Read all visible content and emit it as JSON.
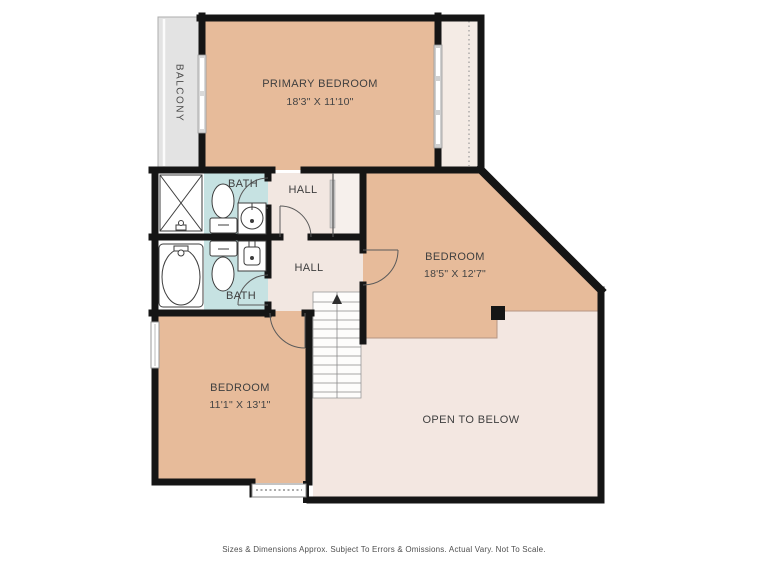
{
  "plan": {
    "rooms": {
      "primary_bedroom": {
        "label": "PRIMARY BEDROOM",
        "dims": "18'3\" X 11'10\""
      },
      "balcony": {
        "label": "BALCONY"
      },
      "bath_top": {
        "label": "BATH"
      },
      "hall_top": {
        "label": "HALL"
      },
      "bath_bottom": {
        "label": "BATH"
      },
      "hall_bottom": {
        "label": "HALL"
      },
      "bedroom_right": {
        "label": "BEDROOM",
        "dims": "18'5\" X 12'7\""
      },
      "bedroom_left": {
        "label": "BEDROOM",
        "dims": "11'1\" X 13'1\""
      },
      "open_to_below": {
        "label": "OPEN TO BELOW"
      }
    },
    "footer_disclaimer": "Sizes & Dimensions Approx. Subject To Errors & Omissions. Actual Vary. Not To Scale.",
    "colors": {
      "wall": "#151515",
      "room_tan": "#e7bb9a",
      "hall_pink": "#f2e7e1",
      "open_pink": "#f3e7e1",
      "bath_teal": "#c6e2e2",
      "balcony_gray": "#e3e3e3"
    }
  }
}
